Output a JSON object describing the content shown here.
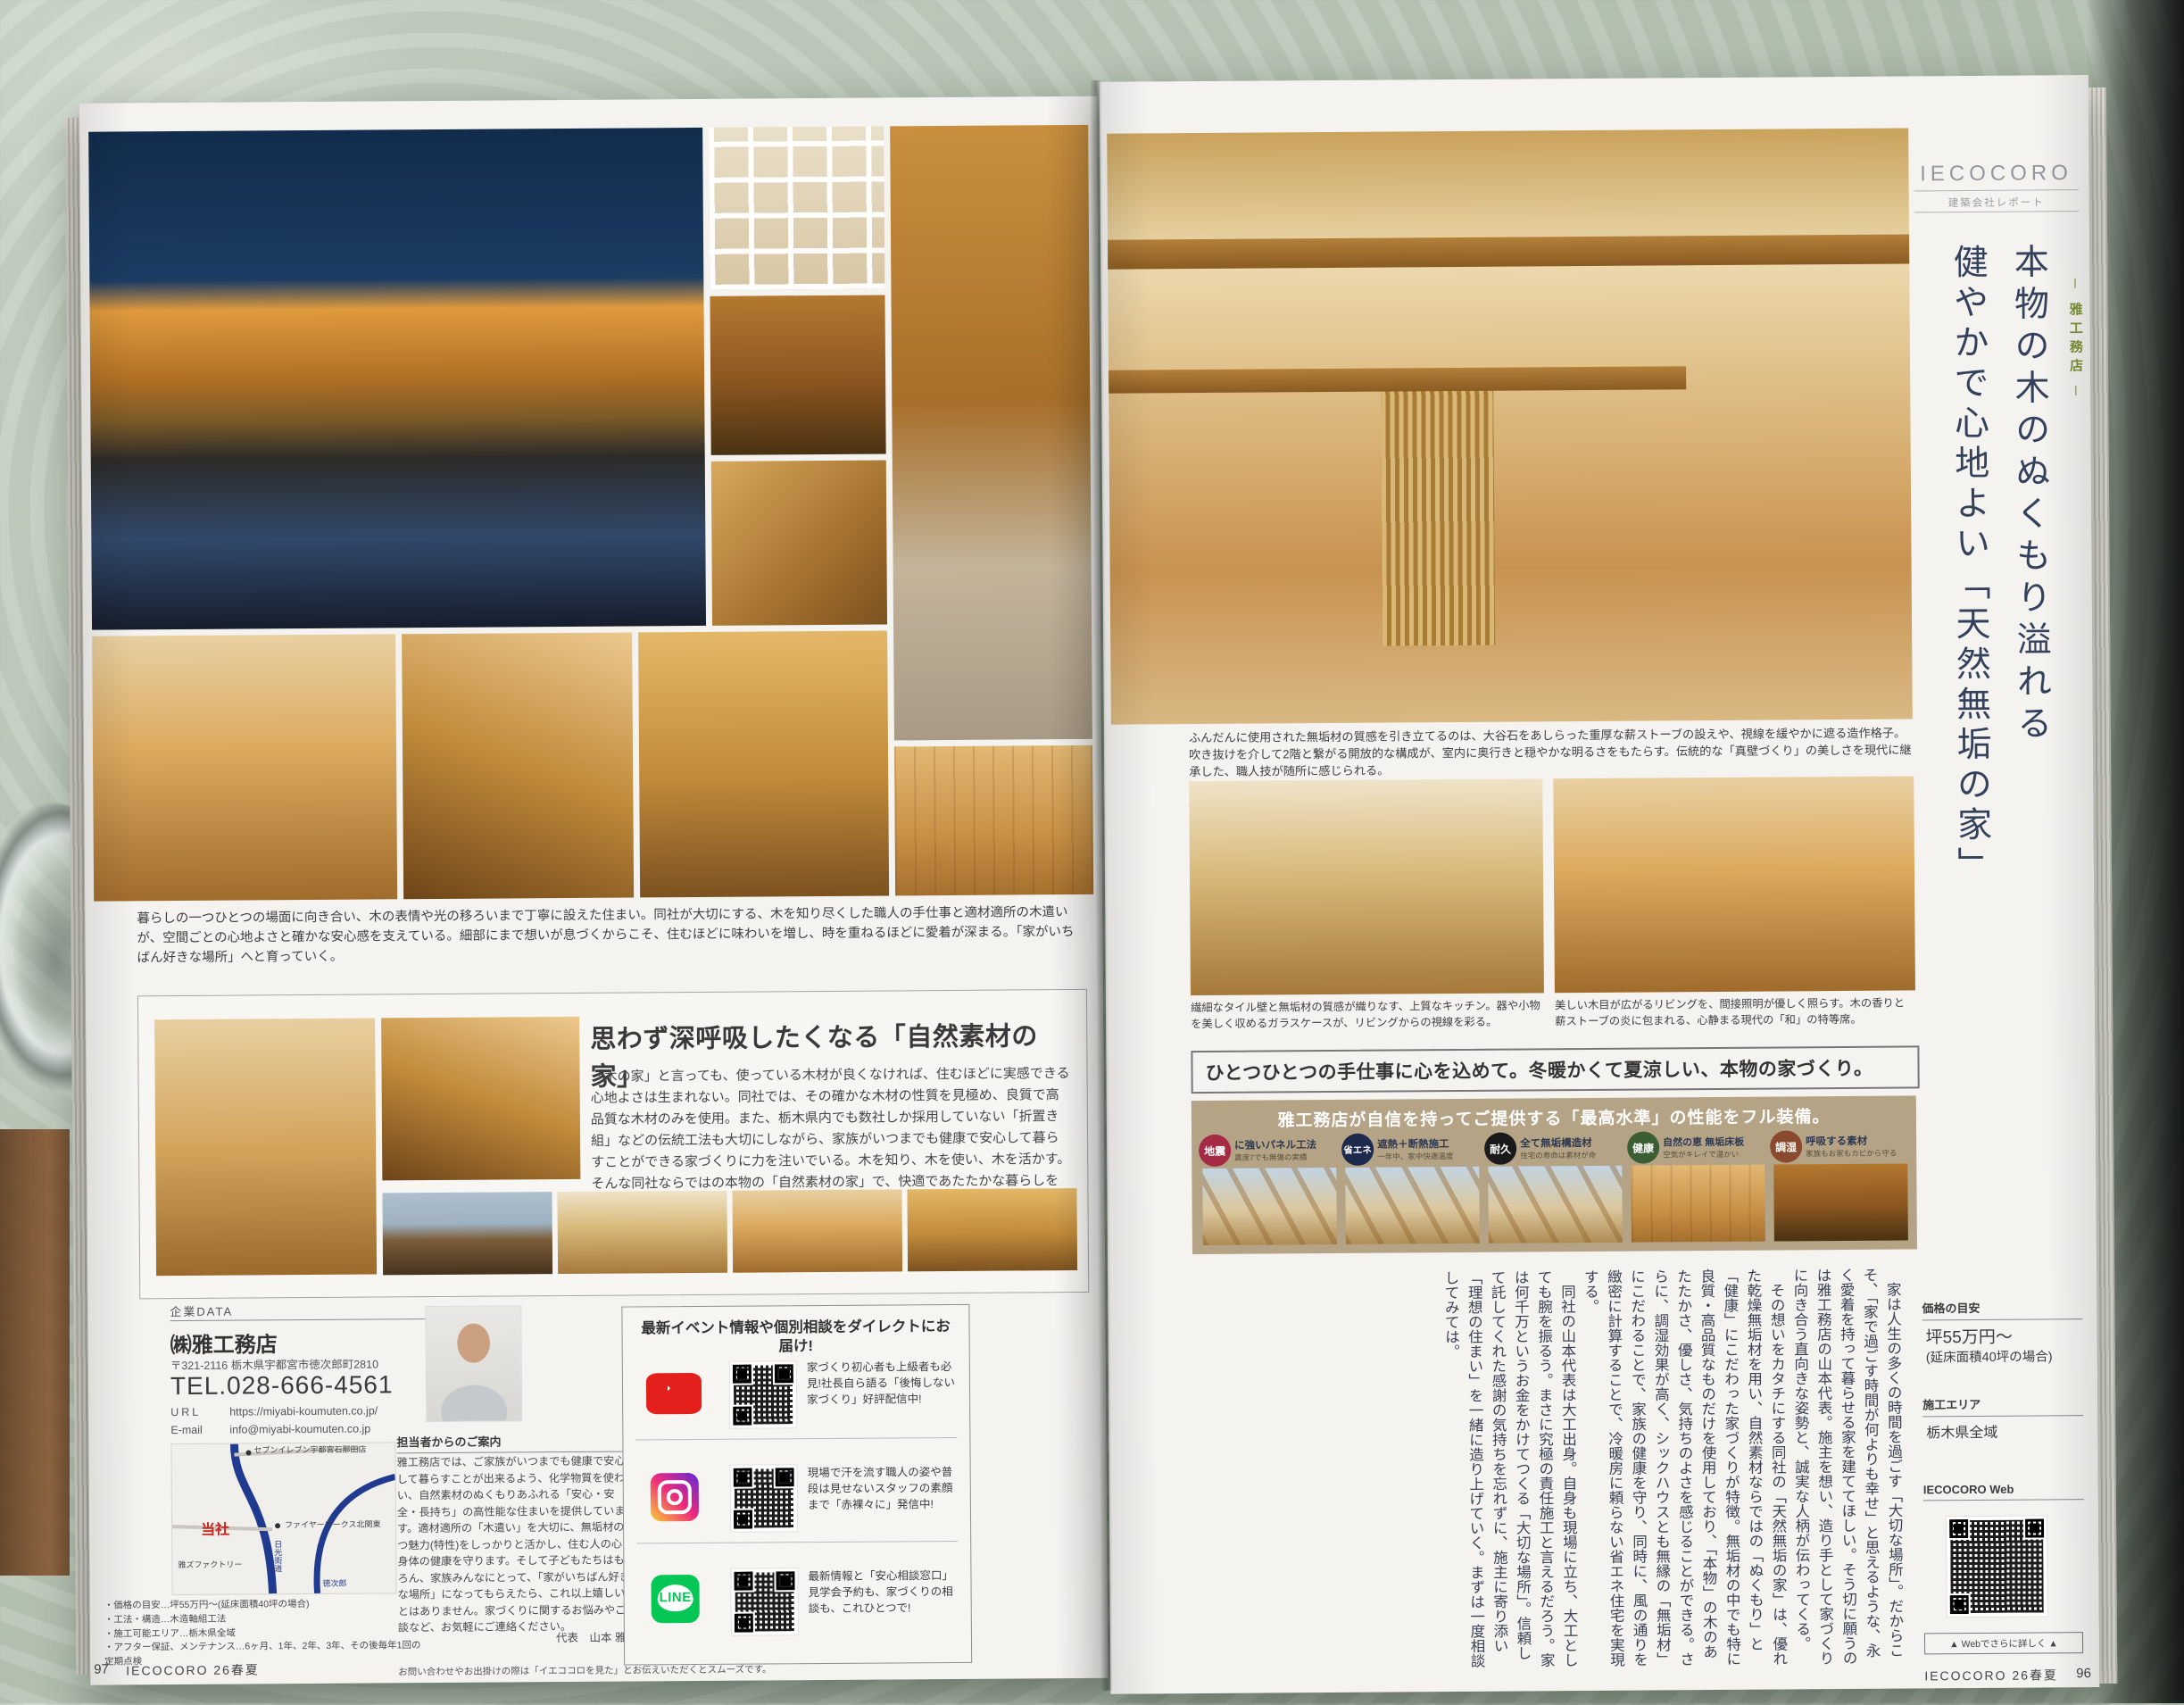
{
  "colors": {
    "headline": "#34415c",
    "tag_green": "#7d9339",
    "banner_bg": "#b5a385",
    "youtube_red": "#e3201b",
    "line_green": "#06c755",
    "map_road_blue": "#1f3a8f",
    "self_red": "#c6251f"
  },
  "page_left": {
    "photo_caption": "暮らしの一つひとつの場面に向き合い、木の表情や光の移ろいまで丁寧に設えた住まい。同社が大切にする、木を知り尽くした職人の手仕事と適材適所の木遣いが、空間ごとの心地よさと確かな安心感を支えている。細部にまで想いが息づくからこそ、住むほどに味わいを増し、時を重ねるほどに愛着が深まる。「家がいちばん好きな場所」へと育っていく。",
    "feature_box": {
      "title": "思わず深呼吸したくなる「自然素材の家」",
      "body": "「木の家」と言っても、使っている木材が良くなければ、住むほどに実感できる心地よさは生まれない。同社では、その確かな木材の性質を見極め、良質で高品質な木材のみを使用。また、栃木県内でも数社しか採用していない「折置き組」などの伝統工法も大切にしながら、家族がいつまでも健康で安心して暮らすことができる家づくりに力を注いでいる。木を知り、木を使い、木を活かす。そんな同社ならではの本物の「自然素材の家」で、快適であたたかな暮らしを実現してみては。"
    },
    "company_data": {
      "label": "企業DATA",
      "name": "㈱雅工務店",
      "address": "〒321-2116 栃木県宇都宮市徳次郎町2810",
      "tel": "TEL.028-666-4561",
      "url_label": "URL",
      "url": "https://miyabi-koumuten.co.jp/",
      "email_label": "E-mail",
      "email": "info@miyabi-koumuten.co.jp",
      "map": {
        "labels": [
          "セブンイレブン宇都宮石那田店",
          "ファイヤーワークス北関東",
          "雅ズファクトリー",
          "日光街道",
          "徳次郎"
        ],
        "self_label": "当社"
      },
      "notes": [
        "・価格の目安…坪55万円〜(延床面積40坪の場合)",
        "・工法・構造…木造軸組工法",
        "・施工可能エリア…栃木県全域",
        "・アフター保証、メンテナンス…6ヶ月、1年、2年、3年、その後毎年1回の定期点検"
      ]
    },
    "staff_message": {
      "title": "担当者からのご案内",
      "body": "雅工務店では、ご家族がいつまでも健康で安心して暮らすことが出来るよう、化学物質を使わない、自然素材のぬくもりあふれる「安心・安全・長持ち」の高性能な住まいを提供しています。適材適所の「木遣い」を大切に、無垢材の持つ魅力(特性)をしっかりと活かし、住む人の心と身体の健康を守ります。そして子どもたちはもちろん、家族みんなにとって、「家がいちばん好きな場所」になってもらえたら、これ以上嬉しいことはありません。家づくりに関するお悩みやご相談など、お気軽にご連絡ください。",
      "signature": "代表　山本 雅之"
    },
    "sns_box": {
      "title": "最新イベント情報や個別相談をダイレクトにお届け!",
      "line_logo": "LINE",
      "items": [
        {
          "icon": "youtube-icon",
          "text": "家づくり初心者も上級者も必見!社長自ら語る「後悔しない家づくり」好評配信中!"
        },
        {
          "icon": "instagram-icon",
          "text": "現場で汗を流す職人の姿や普段は見せないスタッフの素顔まで「赤裸々に」発信中!"
        },
        {
          "icon": "line-icon",
          "text": "最新情報と「安心相談窓口」見学会予約も、家づくりの相談も、これひとつで!"
        }
      ]
    },
    "footer": {
      "page_number": "97",
      "magazine": "IECOCORO 26春夏",
      "note": "お問い合わせやお出掛けの際は「イエココロを見た」とお伝えいただくとスムーズです。"
    }
  },
  "page_right": {
    "brand": {
      "logo": "IECOCORO",
      "sub": "建築会社レポート"
    },
    "company_tag": "─ 雅工務店 ─",
    "headline_line1": "本物の木のぬくもり溢れる",
    "headline_line2": "健やかで心地よい「天然無垢の家」",
    "main_caption": "ふんだんに使用された無垢材の質感を引き立てるのは、大谷石をあしらった重厚な薪ストーブの設えや、視線を緩やかに遮る造作格子。吹き抜けを介して2階と繋がる開放的な構成が、室内に奥行きと穏やかな明るさをもたらす。伝統的な「真壁づくり」の美しさを現代に継承した、職人技が随所に感じられる。",
    "photo_captions": [
      "繊細なタイル壁と無垢材の質感が織りなす、上質なキッチン。器や小物を美しく収めるガラスケースが、リビングからの視線を彩る。",
      "美しい木目が広がるリビングを、間接照明が優しく照らす。木の香りと薪ストーブの炎に包まれる、心静まる現代の「和」の特等席。"
    ],
    "feature_heading": "ひとつひとつの手仕事に心を込めて。冬暖かくて夏涼しい、本物の家づくり。",
    "spec_banner": {
      "title": "雅工務店が自信を持ってご提供する「最高水準」の性能をフル装備。",
      "items": [
        {
          "badge": "地震",
          "badge_color": "#a52a44",
          "title": "に強いパネル工法",
          "sub": "震度7でも無傷の実績"
        },
        {
          "badge": "省エネ",
          "badge_color": "#1d2a4d",
          "title": "遮熱＋断熱施工",
          "sub": "一年中、家中快適温度"
        },
        {
          "badge": "耐久",
          "badge_color": "#1a1a1a",
          "title": "全て無垢構造材",
          "sub": "住宅の寿命は素材が命"
        },
        {
          "badge": "健康",
          "badge_color": "#3c5e35",
          "title": "自然の恵 無垢床板",
          "sub": "空気がキレイで温かい"
        },
        {
          "badge": "調湿",
          "badge_color": "#8a4a2e",
          "title": "呼吸する素材",
          "sub": "家族もお家もカビから守る"
        }
      ]
    },
    "article_paragraphs": [
      "　家は人生の多くの時間を過ごす「大切な場所」。だからこそ、「家で過ごす時間が何よりも幸せ」と思えるような、永く愛着を持って暮らせる家を建ててほしい。そう切に願うのは雅工務店の山本代表。施主を想い、造り手として家づくりに向き合う直向きな姿勢と、誠実な人柄が伝わってくる。",
      "　その想いをカタチにする同社の「天然無垢の家」は、優れた乾燥無垢材を用い、自然素材ならではの「ぬくもり」と「健康」にこだわった家づくりが特徴。無垢材の中でも特に良質・高品質なものだけを使用しており、「本物」の木のあたたかさ、優しさ、気持ちのよさを感じることができる。さらに、調湿効果が高く、シックハウスとも無縁の「無垢材」にこだわることで、家族の健康を守り、同時に、風の通りを緻密に計算することで、冷暖房に頼らない省エネ住宅を実現する。",
      "　同社の山本代表は大工出身。自身も現場に立ち、大工としても腕を振るう。まさに究極の責任施工と言えるだろう。家は何千万というお金をかけてつくる「大切な場所」。信頼して託してくれた感謝の気持ちを忘れずに、施主に寄り添い「理想の住まい」を一緒に造り上げていく。まずは一度相談してみては。"
    ],
    "sidebar": {
      "price_label": "価格の目安",
      "price_line1": "坪55万円〜",
      "price_line2": "(延床面積40坪の場合)",
      "area_label": "施工エリア",
      "area_value": "栃木県全域",
      "web_label": "IECOCORO Web",
      "web_note": "▲ Webでさらに詳しく ▲"
    },
    "footer": {
      "magazine": "IECOCORO 26春夏",
      "page_number": "96"
    }
  }
}
